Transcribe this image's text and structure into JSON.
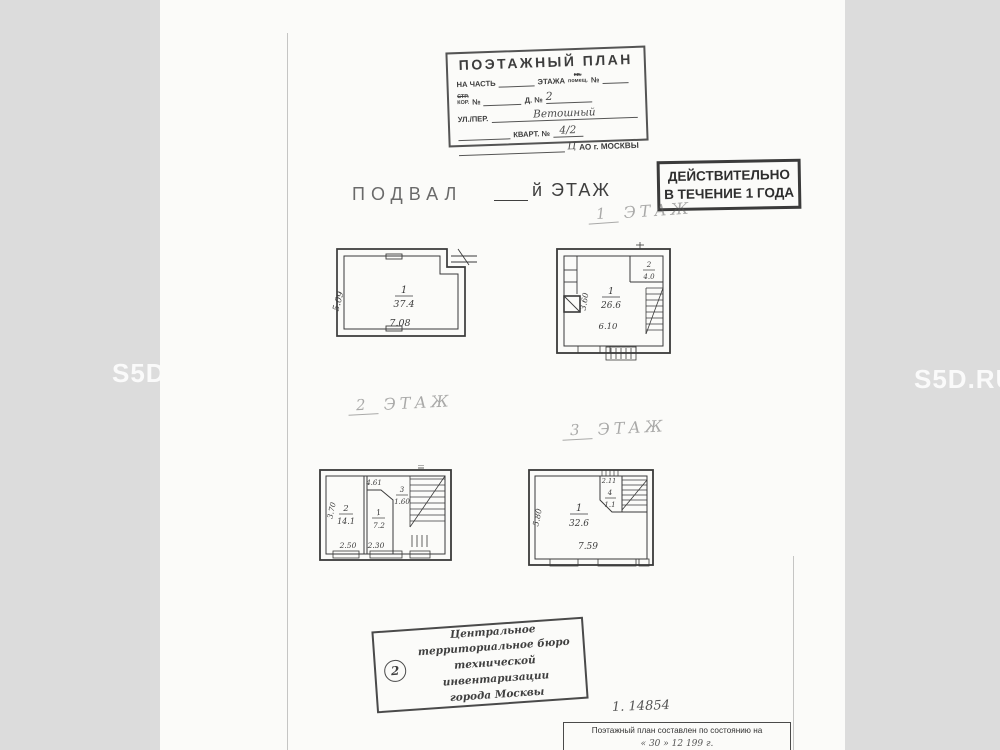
{
  "watermark": {
    "text": "S5D.RU"
  },
  "header_stamp": {
    "title": "ПОЭТАЖНЫЙ ПЛАН",
    "row1_label1": "НА ЧАСТЬ",
    "row1_label2": "ЭТАЖА",
    "row1_small_top": "кв.",
    "row1_small_bottom": "помещ.",
    "row1_no": "№",
    "row2_small_top": "СТР.",
    "row2_small_bottom": "КОР.",
    "row2_no": "№",
    "row2_label": "Д. №",
    "row2_value": "2",
    "row3_label": "УЛ./ПЕР.",
    "row3_value": "Ветошный",
    "row4_label": "КВАРТ. №",
    "row4_value": "4/2",
    "row5_hand": "Ц",
    "row5_text": "АО г. МОСКВЫ"
  },
  "validity_stamp": {
    "line1": "ДЕЙСТВИТЕЛЬНО",
    "line2": "В ТЕЧЕНИЕ 1 ГОДА"
  },
  "floor_labels": {
    "basement": "ПОДВАЛ",
    "basement_suffix": "й ЭТАЖ",
    "f1_num": "1",
    "f1_word": "ЭТАЖ",
    "f2_num": "2",
    "f2_word": "ЭТАЖ",
    "f3_num": "3",
    "f3_word": "ЭТАЖ"
  },
  "plans": {
    "basement": {
      "room": "1",
      "area": "37.4",
      "width": "7.08",
      "height": "5.09"
    },
    "floor1": {
      "room": "1",
      "area": "26.6",
      "width": "6.10",
      "height": "3.60",
      "room2": "2",
      "room2_area": "4.0"
    },
    "floor2": {
      "roomA": "2",
      "roomA_area": "14.1",
      "roomB": "1",
      "roomB_area": "7.2",
      "roomC": "3",
      "roomC_area": "1.60",
      "top": "4.61",
      "height": "3.70",
      "dim1": "2.50",
      "dim2": "2.30"
    },
    "floor3": {
      "room": "1",
      "area": "32.6",
      "width": "7.59",
      "height": "5.80",
      "top": "2.11",
      "room2": "4",
      "room2_area": "1.1"
    }
  },
  "bureau_stamp": {
    "number": "2",
    "line1": "Центральное",
    "line2": "территориальное бюро",
    "line3": "технической инвентаризации",
    "line4": "города Москвы"
  },
  "footer": {
    "note": "1. 14854",
    "line1": "Поэтажный план составлен по состоянию на",
    "line2": "« 30 »  12  199   г."
  }
}
